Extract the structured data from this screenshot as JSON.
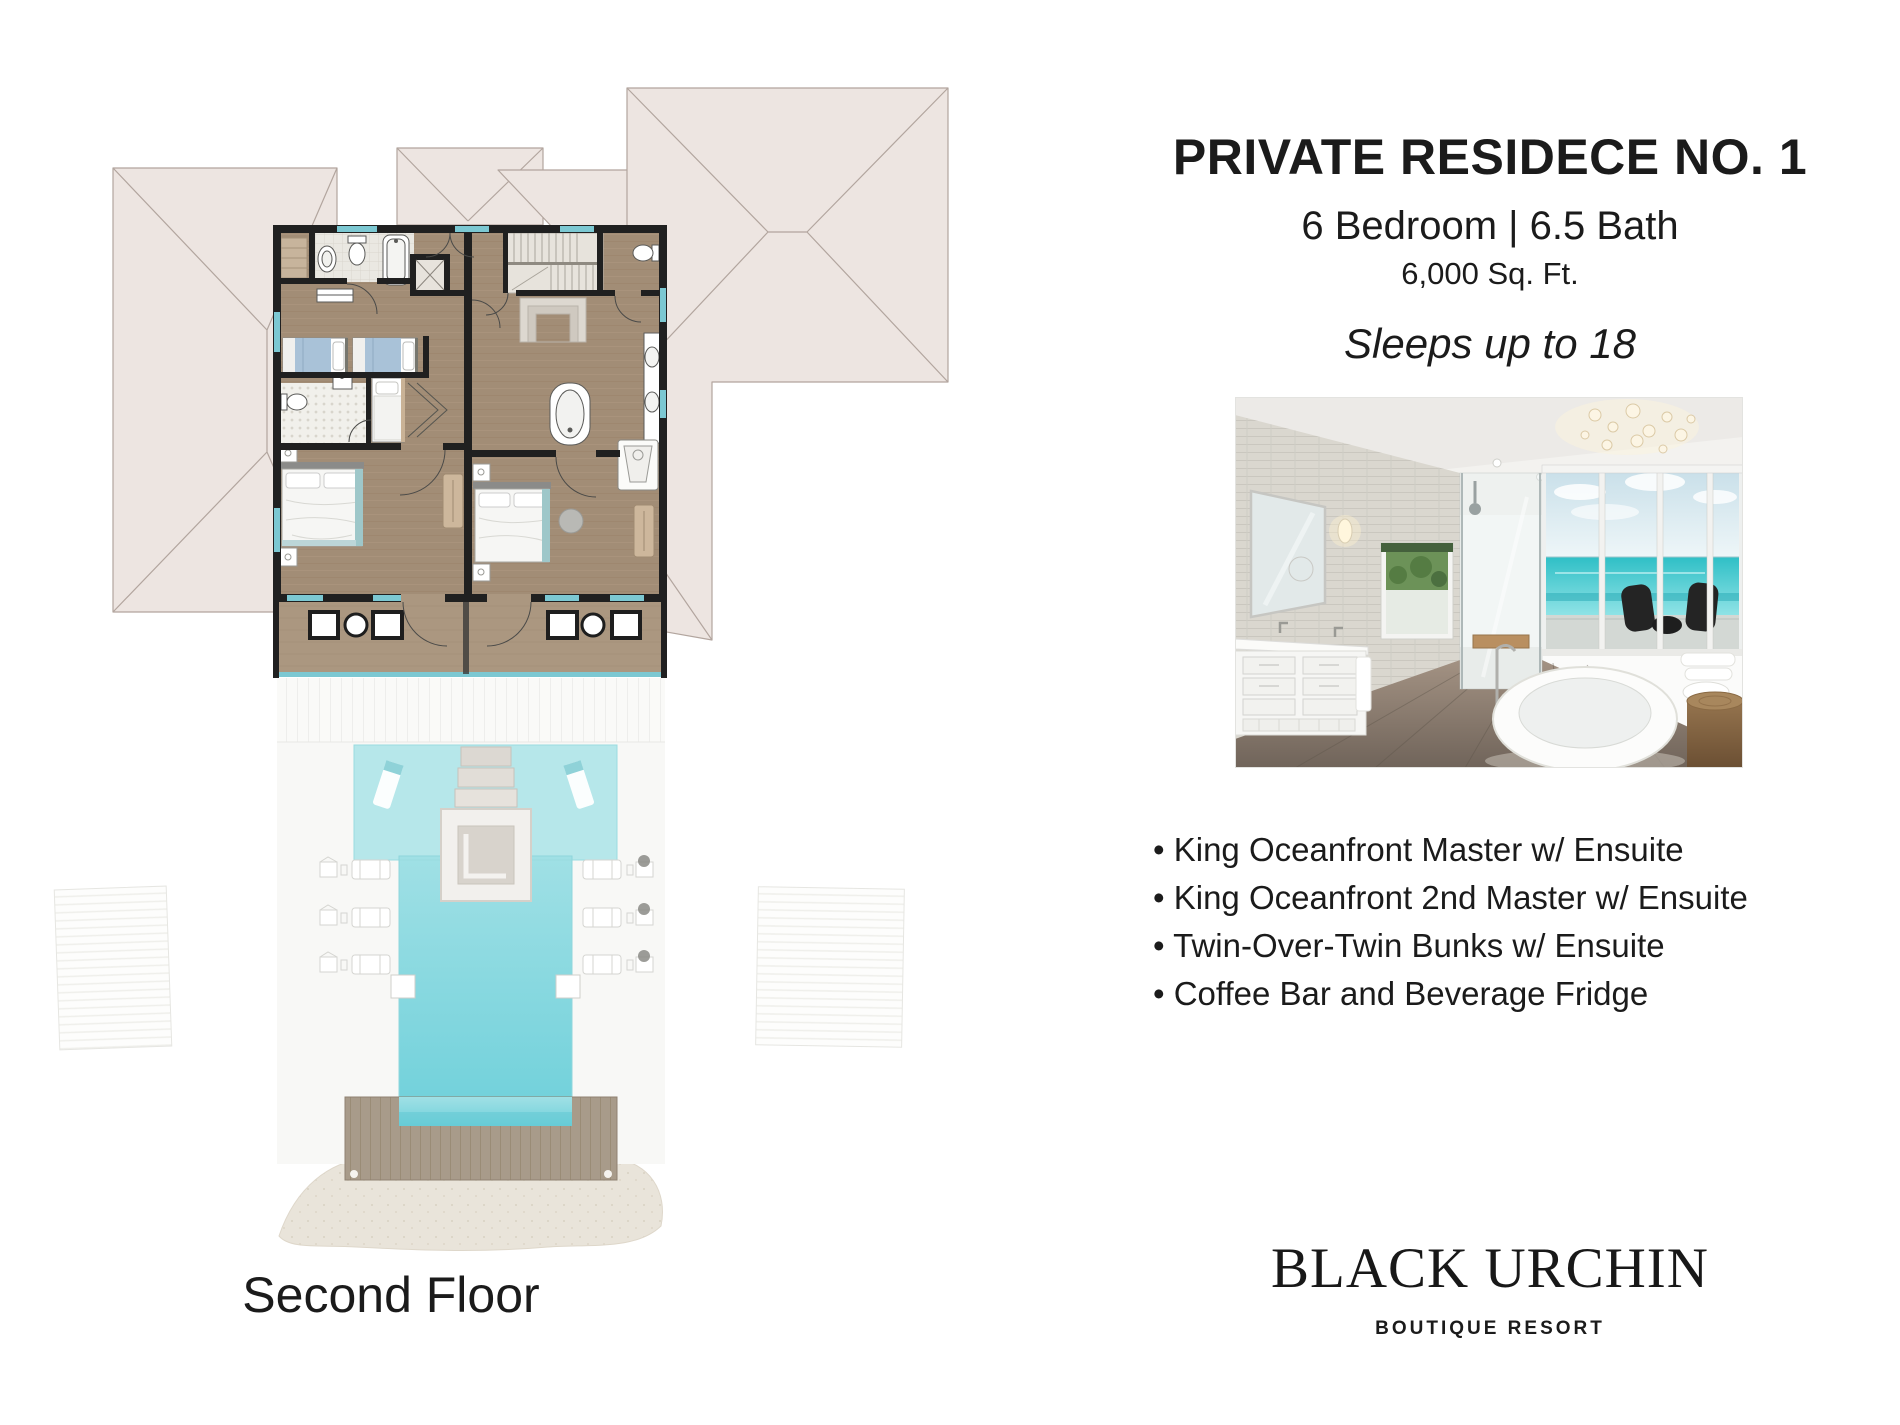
{
  "floor_plan": {
    "label": "Second Floor"
  },
  "residence": {
    "title": "PRIVATE RESIDECE NO. 1",
    "specs": "6 Bedroom | 6.5 Bath",
    "area": "6,000 Sq. Ft.",
    "sleeps": "Sleeps up to 18",
    "bullet": "•",
    "features": [
      "King Oceanfront Master w/ Ensuite",
      "King Oceanfront 2nd Master w/ Ensuite",
      "Twin-Over-Twin Bunks w/ Ensuite",
      "Coffee Bar and Beverage Fridge"
    ]
  },
  "brand": {
    "name": "BLACK URCHIN",
    "tagline": "BOUTIQUE RESORT"
  },
  "colors": {
    "roof": "#ede5e1",
    "wall": "#202020",
    "wood_floor": "#a28d76",
    "balcony_wood": "#ab9780",
    "tile": "#eae8e2",
    "pool": "#74d2da",
    "pool_shallow": "#b6e7ea",
    "window_accent": "#7cc8d2",
    "deck_wood": "#a89b8a",
    "sand": "#e9e4da",
    "ocean": "#3ec3c9",
    "bed_blue": "#a9c2d8"
  }
}
